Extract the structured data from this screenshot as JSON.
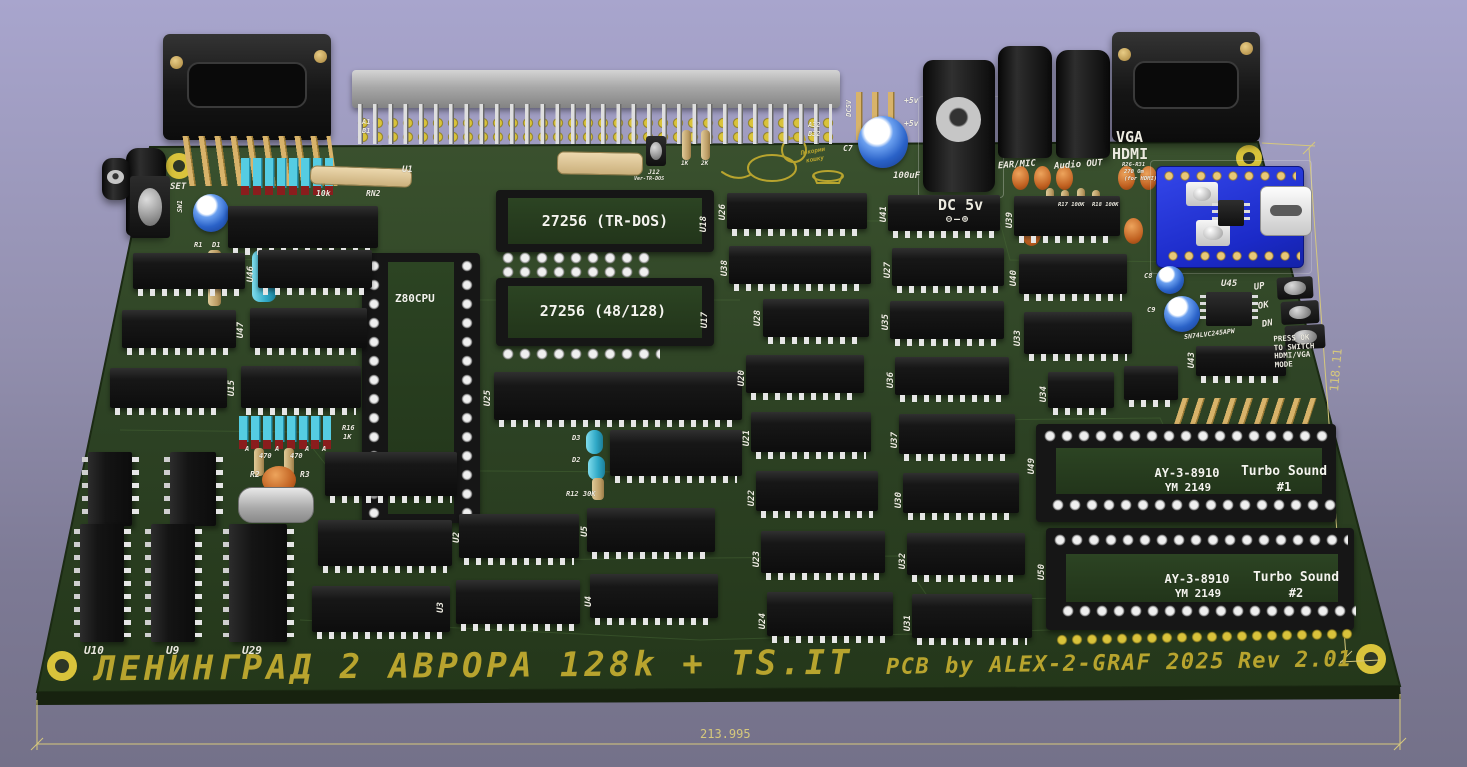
{
  "scene": {
    "bg_top": "#a8a5cd",
    "bg_bottom": "#747189",
    "board_green": "#33492a",
    "board_green_dark": "#243619",
    "silk_white": "#eceae0",
    "silk_yellow": "#b8a42e",
    "dim_color": "#d6c87c",
    "module_blue": "#2236d6"
  },
  "board": {
    "title": "ЛЕНИНГРАД 2 АВРОРА 128k + TS.IT",
    "credit": "PCB by ALEX-2-GRAF 2025",
    "revision": "Rev 2.01",
    "dim_width": "213.995",
    "dim_height": "118.11"
  },
  "edge_connector": {
    "a1": "A1",
    "b1": "B1",
    "a32": "A32",
    "b32": "B32"
  },
  "power": {
    "header": "DC5V",
    "pin1": "+5v",
    "pin2": "+5v",
    "cap_ref": "C7",
    "cap_val": "100uF",
    "jack": "DC 5v",
    "polarity": "⊖–⊕"
  },
  "audio": {
    "ear": "EAR/MIC",
    "out": "Audio OUT"
  },
  "video": {
    "vga": "VGA",
    "hdmi": "HDMI",
    "note1": "R26-R31",
    "note2": "270 Om",
    "note3": "(for HDMI)"
  },
  "hdmi_ctrl": {
    "u45": "U45",
    "ic": "SN74LVC245APW",
    "up": "UP",
    "ok": "OK",
    "dn": "DN",
    "note": "PRESS OK\nTO SWITCH\nHDMI/VGA\nMODE",
    "c8": "C8",
    "c9": "C9"
  },
  "cpu": {
    "socket": "Z80CPU",
    "u25": "U25",
    "u1": "U1"
  },
  "roms": {
    "rom1": "27256 (TR-DOS)",
    "rom1_ref": "U18",
    "rom2": "27256 (48/128)",
    "rom2_ref": "U17"
  },
  "sound": {
    "ay1_name": "AY-3-8910",
    "ay1_sub": "YM 2149",
    "ts1": "Turbo Sound",
    "ts1_num": "#1",
    "u49": "U49",
    "ay2_name": "AY-3-8910",
    "ay2_sub": "YM 2149",
    "ts2": "Turbo Sound",
    "ts2_num": "#2",
    "u50": "U50"
  },
  "refs": {
    "u2": "U2",
    "u3": "U3",
    "u4": "U4",
    "u5": "U5",
    "u9": "U9",
    "u10": "U10",
    "u15": "U15",
    "u20": "U20",
    "u21": "U21",
    "u22": "U22",
    "u23": "U23",
    "u24": "U24",
    "u26": "U26",
    "u27": "U27",
    "u28": "U28",
    "u29": "U29",
    "u30": "U30",
    "u31": "U31",
    "u32": "U32",
    "u33": "U33",
    "u34": "U34",
    "u35": "U35",
    "u36": "U36",
    "u37": "U37",
    "u38": "U38",
    "u39": "U39",
    "u40": "U40",
    "u41": "U41",
    "u43": "U43",
    "u46": "U46",
    "u47": "U47"
  },
  "passives": {
    "rn_val": "10k",
    "rn2": "RN2",
    "r1": "R1",
    "d1": "D1",
    "sw": "SW1",
    "set": "SET",
    "r16": "R16",
    "r16_val": "1K",
    "pad_a": "A",
    "r470": "470",
    "r2": "R2",
    "r3": "R3",
    "d2": "D2",
    "d3": "D3",
    "r12": "R12 30K",
    "j12": "J12",
    "j12_note": "Ver-TR-DOS",
    "r1k": "1K",
    "r2k": "2K",
    "r17": "R17 100K",
    "r18": "R18 100K"
  },
  "notes": {
    "cat_line1": "Покорми",
    "cat_line2": "кошку"
  }
}
